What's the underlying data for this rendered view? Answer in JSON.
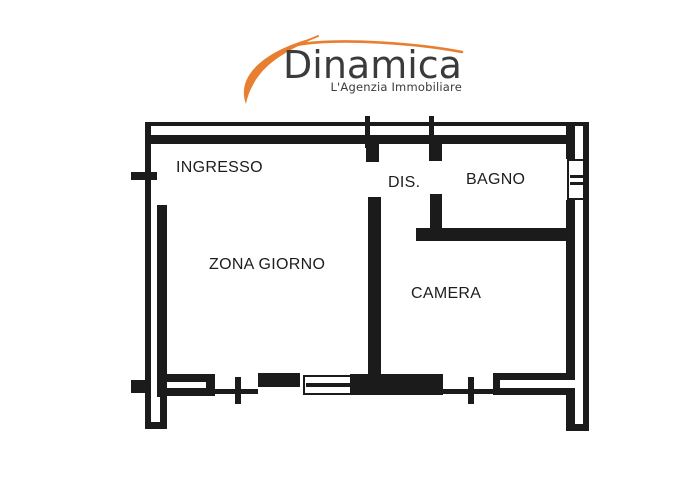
{
  "logo": {
    "brand": "Dinamica",
    "tagline": "L'Agenzia Immobiliare",
    "colors": {
      "accent": "#E87E2F",
      "text": "#3B3B3A"
    }
  },
  "floorplan": {
    "colors": {
      "ink": "#1B1B1B",
      "label": "#1D1D1D"
    },
    "rooms": [
      {
        "label": "INGRESSO"
      },
      {
        "label": "DIS."
      },
      {
        "label": "BAGNO"
      },
      {
        "label": "ZONA GIORNO"
      },
      {
        "label": "CAMERA"
      }
    ]
  }
}
